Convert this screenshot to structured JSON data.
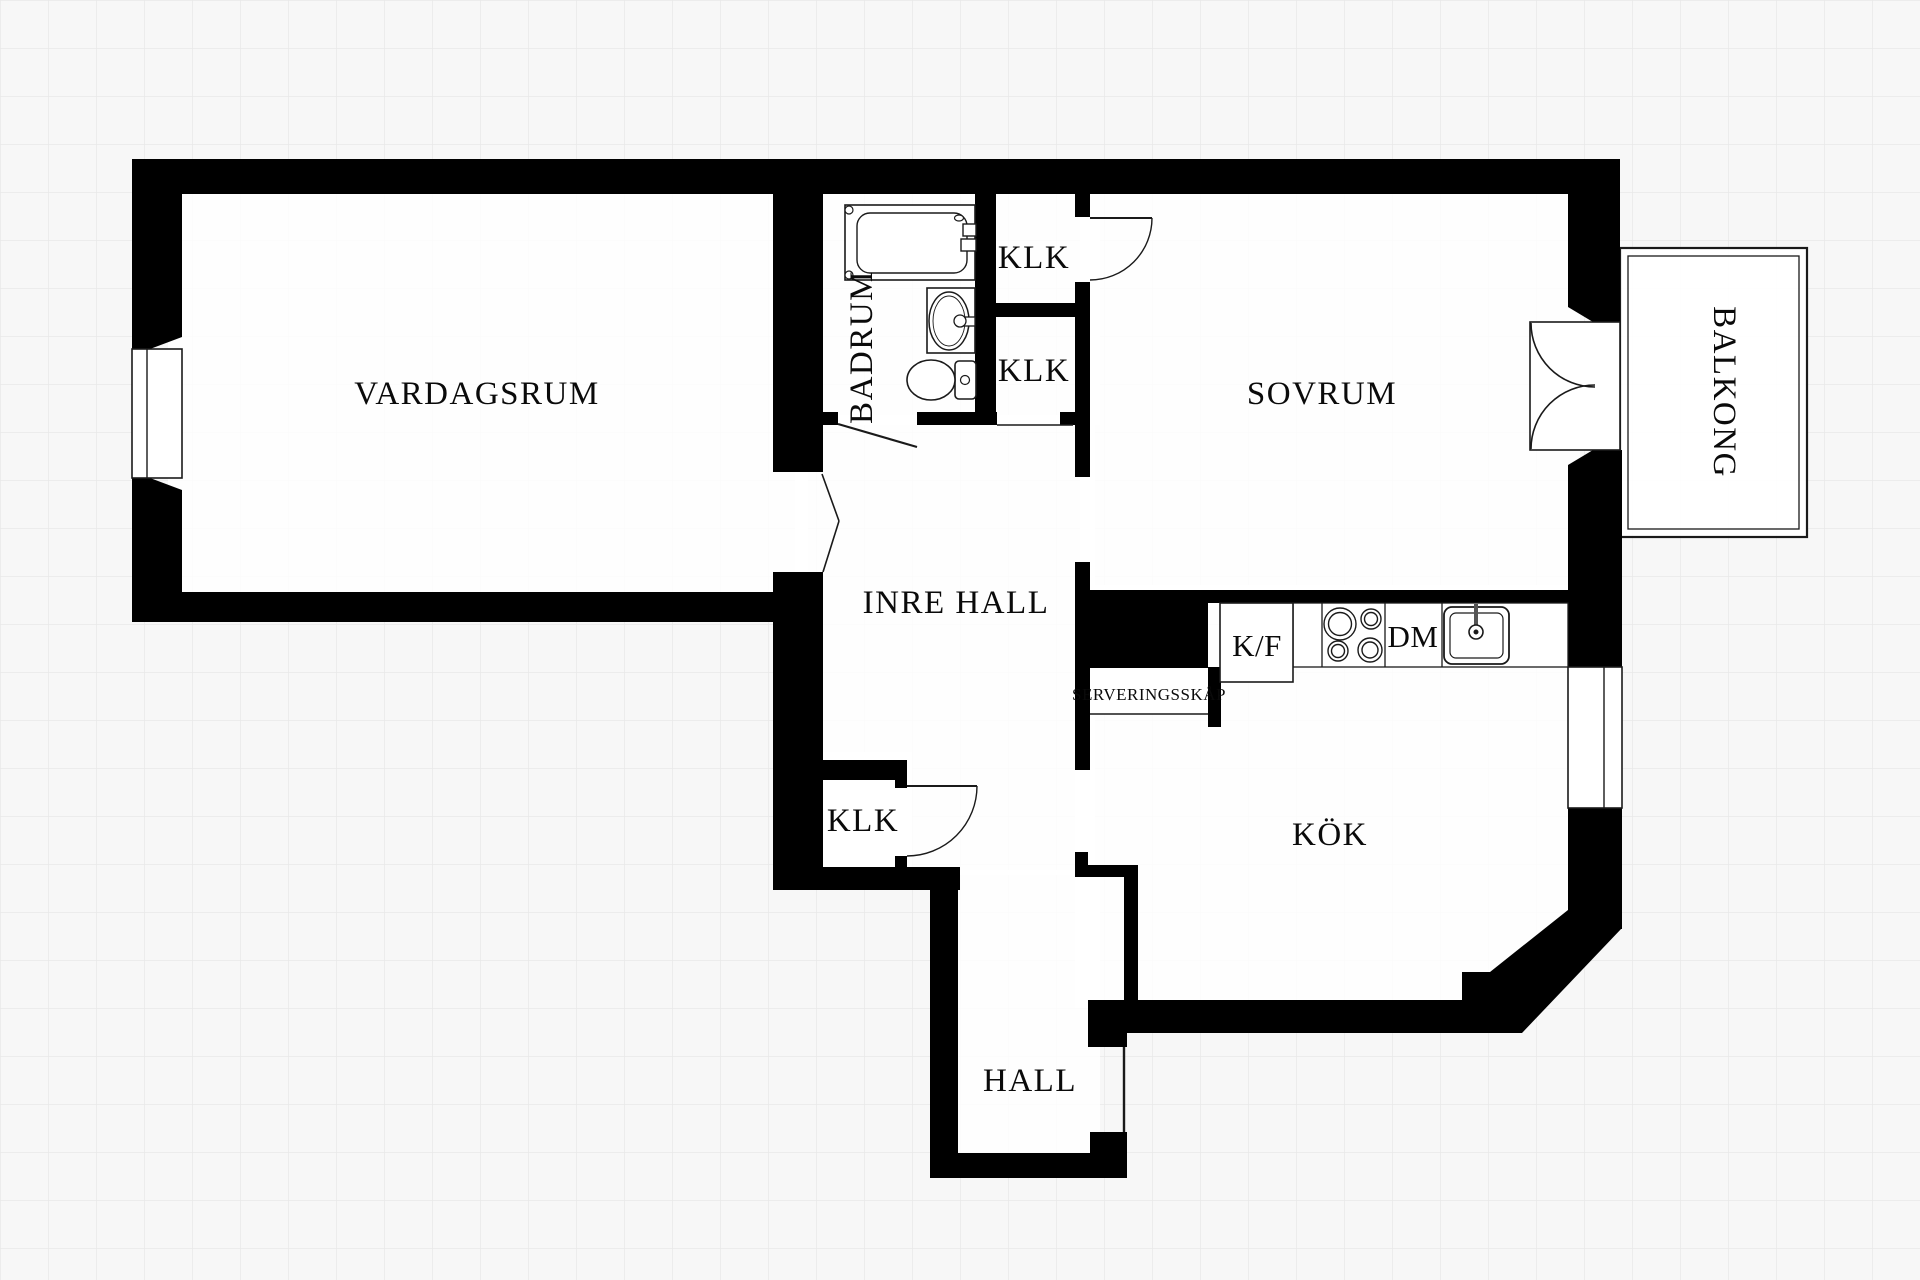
{
  "plan": {
    "title": "apartment-floorplan",
    "rooms": {
      "vardagsrum": "VARDAGSRUM",
      "sovrum": "SOVRUM",
      "badrum": "BADRUM",
      "balkong": "BALKONG",
      "inre_hall": "INRE HALL",
      "kok": "KÖK",
      "hall": "HALL",
      "klk_upper": "KLK",
      "klk_mid": "KLK",
      "klk_lower": "KLK",
      "serveringsskap": "SERVERINGSSKÅP"
    },
    "appliances": {
      "fridge_freezer": "K/F",
      "dishwasher": "DM"
    },
    "fixtures": [
      "bathtub",
      "washbasin",
      "toilet",
      "stove-burners",
      "kitchen-sink"
    ],
    "colors": {
      "wall": "#000000",
      "floor": "#ffffff",
      "background": "#f7f7f7",
      "grid": "#e8e8e8",
      "line": "#1a1a1a"
    }
  }
}
